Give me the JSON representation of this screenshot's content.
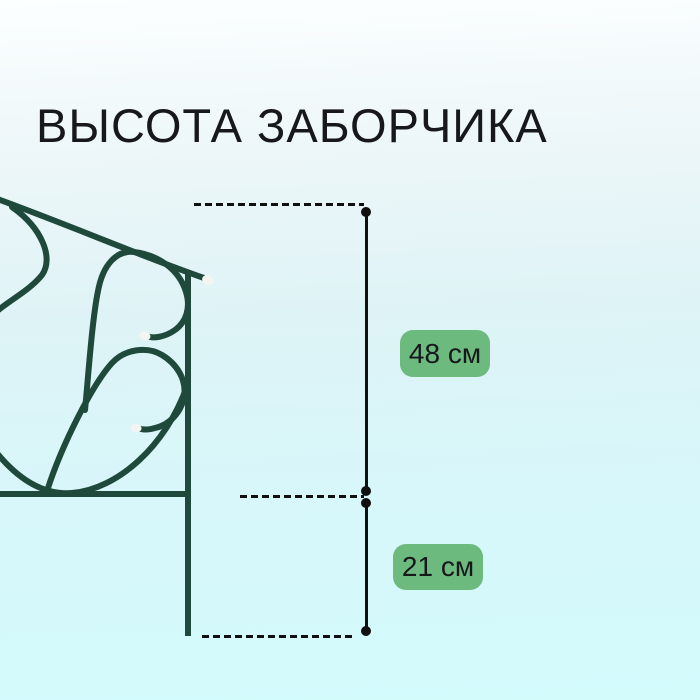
{
  "title": "ВЫСОТА ЗАБОРЧИКА",
  "measurements": {
    "upper": {
      "value": "48",
      "unit": "см",
      "label": "48 см"
    },
    "lower": {
      "value": "21",
      "unit": "см",
      "label": "21 см"
    }
  },
  "illustration": {
    "name": "decorative-garden-fence-section",
    "description": "dark green curved wire fence with white tip caps, cropped at left edge"
  },
  "colors": {
    "bg_top": "#fcffff",
    "bg_bottom": "#d3fbfc",
    "line_black": "#101010",
    "badge_green": "#6cba7e",
    "fence_green": "#1f4a3b",
    "cap_white": "#f2f5f1",
    "title_color": "#17181c"
  }
}
